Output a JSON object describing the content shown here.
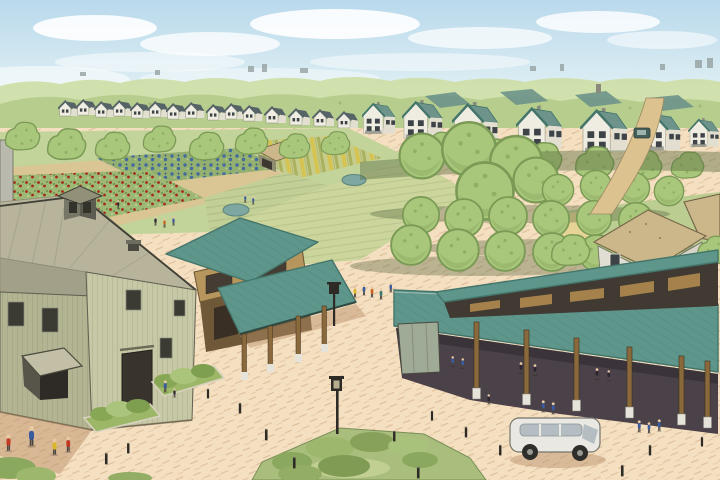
{
  "scene": {
    "kind": "watercolor-illustration",
    "subject": "aerial view of an agrihood: barn, farm stand, market pavilion, community gardens, orchard and rows of houses"
  },
  "palette": {
    "sky1": "#b9d9ec",
    "sky2": "#ddeef3",
    "sky3": "#eef5ee",
    "cloud": "#ffffff",
    "canopyFar": "#cfdfa9",
    "canopyMid": "#b7cd8d",
    "treeGreen": "#a9c77b",
    "treeDark": "#7a9a55",
    "houseWall": "#efede1",
    "houseWallShade": "#e2dfd1",
    "roofSlate": "#566467",
    "roofTeal": "#6d938a",
    "tealRoofDark": "#44756b",
    "windowDark": "#3e4347",
    "field": "#c3d49b",
    "gardenPath": "#dcc493",
    "flowerRed": "#a52a17",
    "cabbageBlue": "#44699f",
    "cropYellow": "#d6c452",
    "sand": "#f4dfc0",
    "sandHatch": "#c49b72",
    "shadowTan": "#b98f68",
    "barnWall": "#c7c8a6",
    "barnWallShade": "#b2b492",
    "barnRoof": "#b7b49b",
    "barnRoofShade": "#a3a089",
    "barnTrim": "#3f3f35",
    "woodTan": "#b6965c",
    "woodDark": "#6b5433",
    "stallDark": "#3a2f24",
    "tealRoof": "#5e968c",
    "paviInterior": "#4b4149",
    "postWood": "#8a6a3c",
    "postBase": "#e5e3da",
    "slatTan": "#b08a4e",
    "cottageRoof": "#cbb789",
    "cottageWall": "#e0ddd3",
    "water": "#7fa7a2",
    "grassRight": "#bccd92",
    "lawnTan": "#e7d395",
    "islandGreen": "#a9bd7c",
    "roadTan": "#dbc28f",
    "vanBody": "#e9e8e2",
    "vanWindow": "#b4bec2",
    "personRed": "#c23a24",
    "personBlue": "#3a5b9e",
    "personYellow": "#d9b62a",
    "personTeal": "#3a7a72",
    "figureDark": "#2c2630",
    "skin": "#e8c9a4",
    "dark": "#2e2b26"
  }
}
